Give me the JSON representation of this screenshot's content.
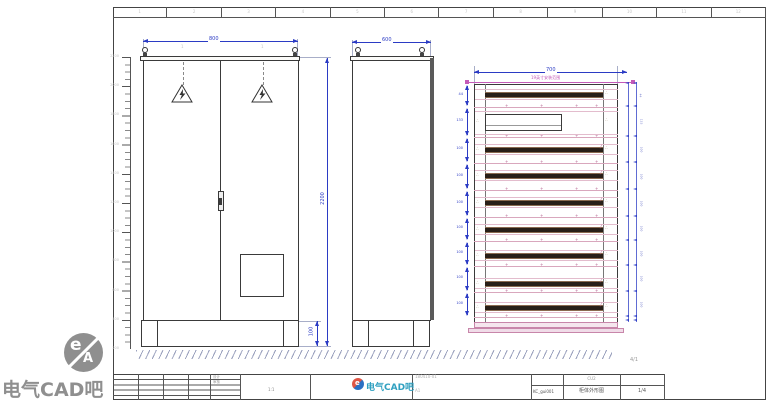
{
  "watermark": {
    "circle_text_e": "e",
    "circle_text_a": "A",
    "label": "电气CAD吧"
  },
  "zone_ref": "4/1",
  "zones": [
    "1",
    "2",
    "3",
    "4",
    "5",
    "6",
    "7",
    "8",
    "9",
    "10",
    "11",
    "12"
  ],
  "ruler_labels": [
    "2200",
    "2000",
    "1800",
    "1600",
    "1400",
    "1200",
    "1000",
    "800",
    "600",
    "400",
    "200"
  ],
  "front_view": {
    "width_dim": "800",
    "height_dim": "2200",
    "plinth_dim": "100",
    "callout_left": "1",
    "callout_right": "1"
  },
  "side_view": {
    "width_dim": "600"
  },
  "rack_view": {
    "width_dim": "700",
    "rail_label": "19英寸安装范围",
    "separator_ys": [
      107,
      137,
      163,
      190,
      217,
      241,
      266,
      292,
      317
    ],
    "rows": [
      {
        "type": "bar",
        "y": 92,
        "dim": "44"
      },
      {
        "type": "box",
        "y": 114,
        "dim": "133"
      },
      {
        "type": "bar",
        "y": 147,
        "dim": "100"
      },
      {
        "type": "bar",
        "y": 173,
        "dim": "100"
      },
      {
        "type": "bar",
        "y": 200,
        "dim": "100"
      },
      {
        "type": "bar",
        "y": 227,
        "dim": "100"
      },
      {
        "type": "bar",
        "y": 253,
        "dim": "100"
      },
      {
        "type": "bar",
        "y": 281,
        "dim": "100"
      },
      {
        "type": "bar",
        "y": 305,
        "dim": "100"
      }
    ]
  },
  "title_block": {
    "logo": {
      "icon": "ea-badge",
      "text": "电气CAD吧"
    },
    "doc_code": "180410-01",
    "rev": "A1",
    "cell_code": "CU2",
    "drawing_no": "KC_gui001",
    "drawing_title": "柜体外形图",
    "page": "1/4",
    "labels": {
      "design": "设计",
      "check": "审核",
      "scale": "1:1"
    }
  }
}
